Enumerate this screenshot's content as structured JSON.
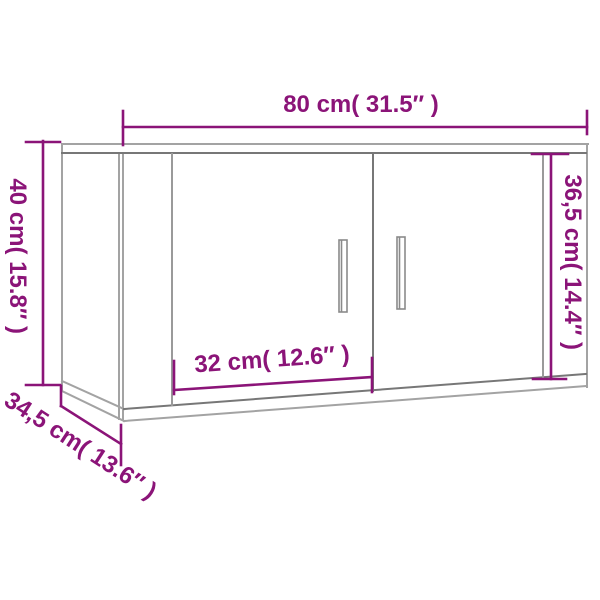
{
  "diagram": {
    "type": "product-dimension-diagram",
    "subject": "two-door wall-mounted cabinet, line drawing",
    "colors": {
      "dimension_accent": "#8b1478",
      "cabinet_line_light": "#a3a3a3",
      "cabinet_line_dark": "#777777",
      "background": "#ffffff"
    },
    "labels": {
      "width": "80 cm( 31.5″ )",
      "height": "40 cm( 15.8″ )",
      "door_height": "36,5 cm( 14.4″ )",
      "door_width": "32 cm( 12.6″ )",
      "depth": "34,5 cm( 13.6″ )"
    }
  }
}
